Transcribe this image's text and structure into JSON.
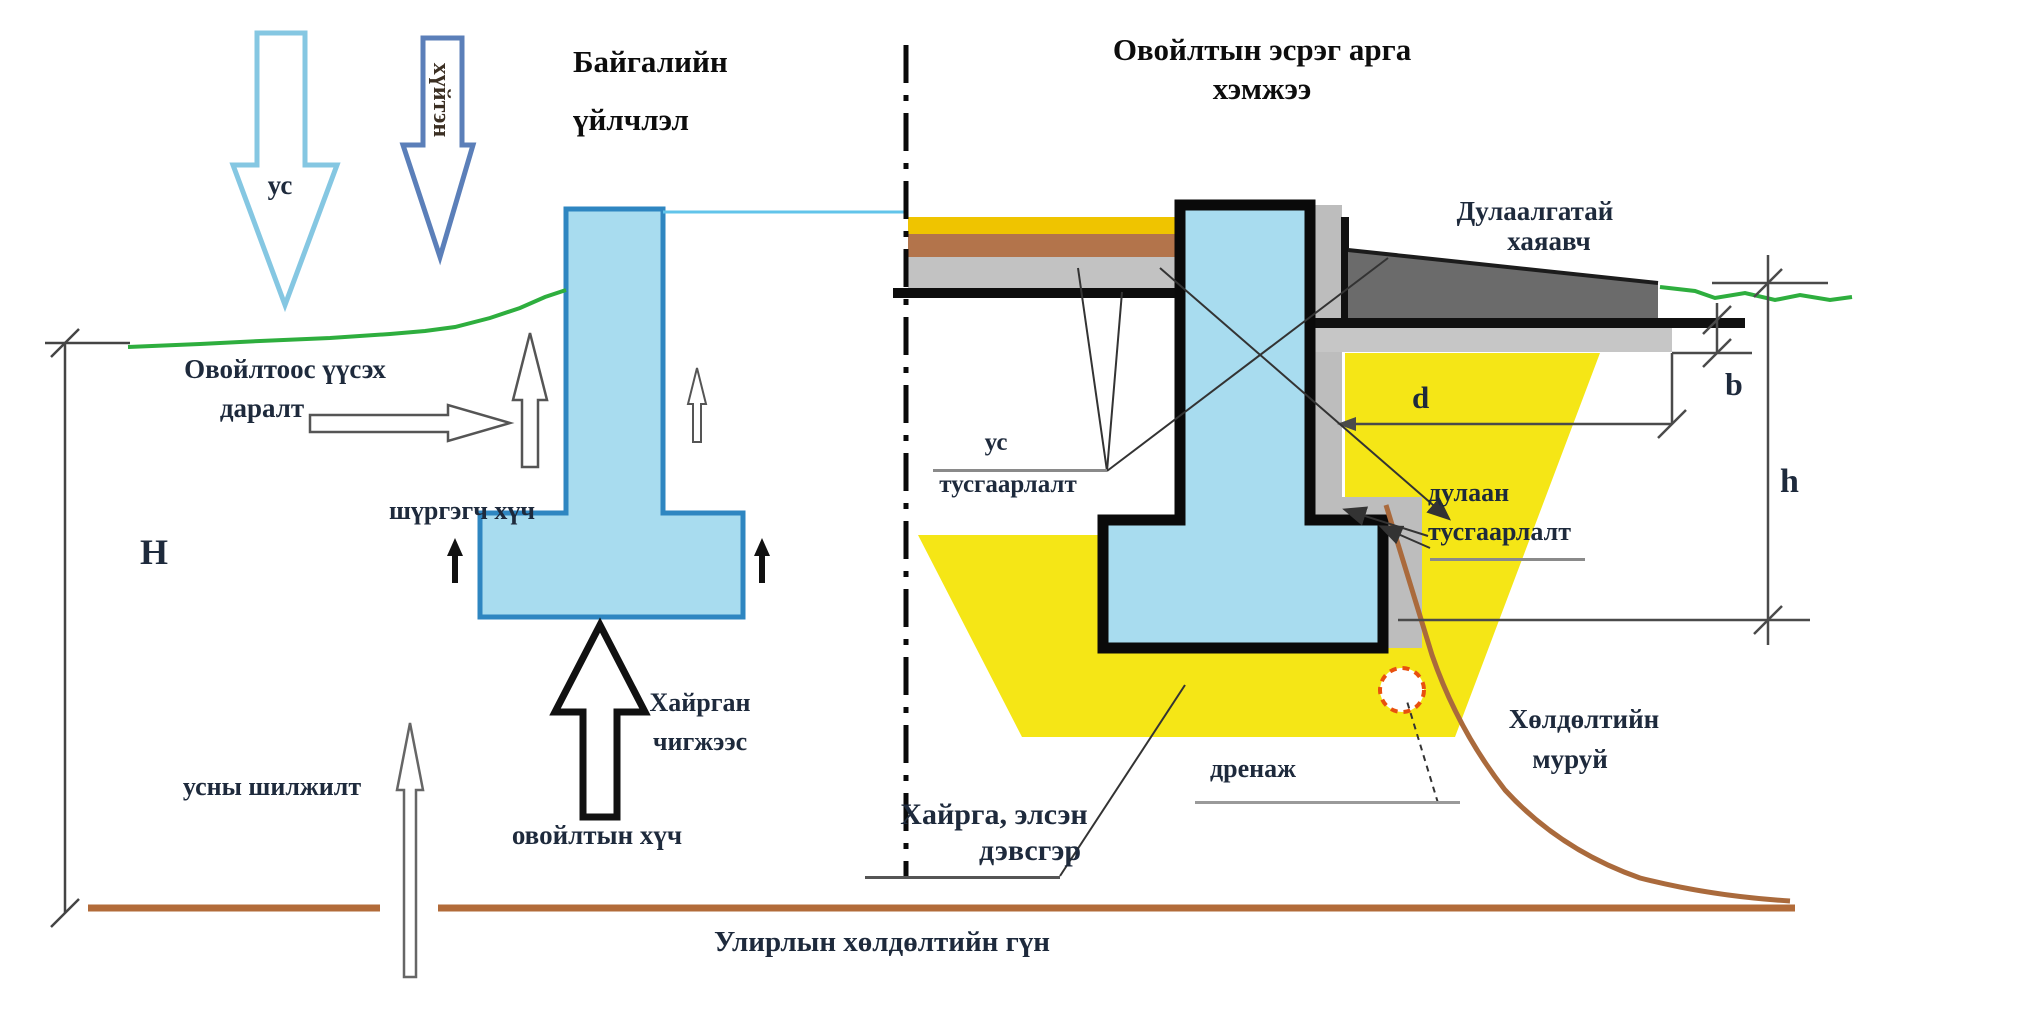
{
  "titles": {
    "left_line1": "Байгалийн",
    "left_line2": "үйлчлэл",
    "right_line1": "Овойлтын эсрэг арга",
    "right_line2": "хэмжээ"
  },
  "left_diagram": {
    "water_arrow_label": "ус",
    "cold_arrow_label": "хүйтэн",
    "heave_pressure_line1": "Овойлтоос үүсэх",
    "heave_pressure_line2": "даралт",
    "tangential_force": "шүргэгч хүч",
    "gravel_packing_line1": "Хайрган",
    "gravel_packing_line2": "чигжээс",
    "heave_force": "овойлтын хүч",
    "water_movement": "усны шилжилт",
    "depth_dim": "H"
  },
  "right_diagram": {
    "insulated_apron_line1": "Дулаалгатай",
    "insulated_apron_line2": "хаяавч",
    "waterproofing_line1": "ус",
    "waterproofing_line2": "тусгаарлалт",
    "thermal_insulation_line1": "дулаан",
    "thermal_insulation_line2": "тусгаарлалт",
    "drainage": "дренаж",
    "bedding_line1": "Хайрга, элсэн",
    "bedding_line2": "дэвсгэр",
    "frost_curve_line1": "Хөлдөлтийн",
    "frost_curve_line2": "муруй",
    "dim_b": "b",
    "dim_d": "d",
    "dim_h": "h"
  },
  "bottom": {
    "frost_depth_caption": "Улирлын хөлдөлтийн гүн"
  },
  "colors": {
    "foundation_fill": "#a8dcef",
    "foundation_border": "#2e86c1",
    "wall_outline": "#0a0a0a",
    "pit_yellow": "#f5e616",
    "floor_yellow": "#efc400",
    "floor_brown": "#b3744b",
    "floor_gray": "#c2c2c2",
    "insulation_gray": "#bdbdbd",
    "apron_gray": "#6b6b6b",
    "ground_green": "#2eae3e",
    "frost_brown": "#b26b39",
    "drain_red": "#e8500e",
    "water_arrow_blue": "#85c7e2",
    "cold_arrow_blue": "#5b7fb9"
  }
}
